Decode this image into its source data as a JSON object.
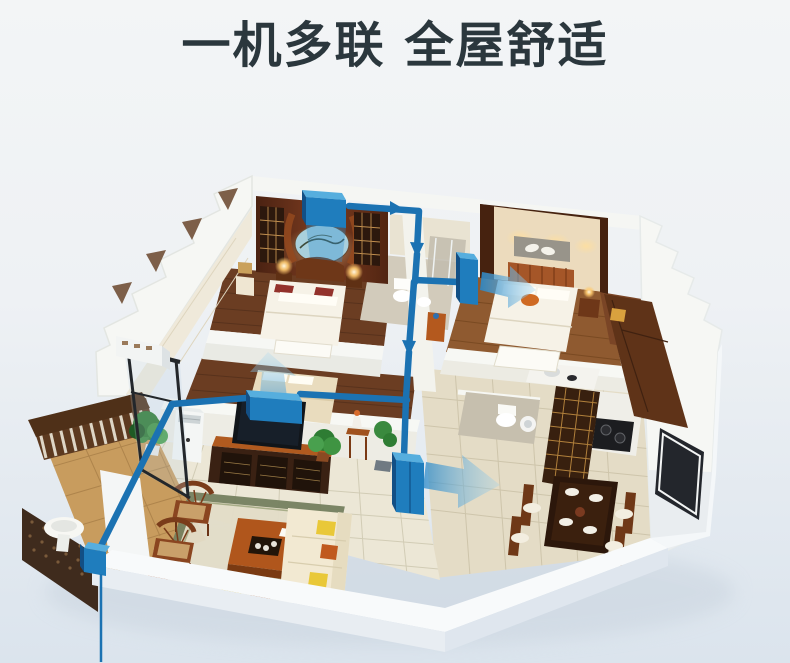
{
  "title": "一机多联 全屋舒适",
  "colors": {
    "bg_top": "#f3f5f6",
    "bg_bottom": "#dbe4ed",
    "title_text": "#2b373d",
    "duct_blue": "#1b72b2",
    "duct_blue_light": "#56aede",
    "duct_blue_dark": "#124f85",
    "airflow_blue": "#58abdf"
  },
  "scene": {
    "type": "3d-cutaway-floorplan",
    "description": "Isometric 3D cutaway apartment showing a concealed multi-split air conditioning system: blue ducts run along the wall tops to indoor units in the Chinese-style master bedroom, the second bedroom, the guest bedroom and the living/dining area; translucent blue arrows show airflow into each room and a refrigerant line drops down the balcony toward the outdoor unit below the frame.",
    "rooms": [
      "chinese-master-bedroom",
      "second-bedroom",
      "guest-bedroom",
      "living-room",
      "dining-room",
      "kitchen",
      "bathroom",
      "ensuite-bathroom",
      "balcony"
    ],
    "hvac": {
      "indoor_units": 4,
      "junction_box_on_balcony": 1,
      "airflow_arrows": 3,
      "pipe_arrows": 3,
      "outdoor_line": "thin blue line from balcony junction to bottom edge of image"
    }
  }
}
